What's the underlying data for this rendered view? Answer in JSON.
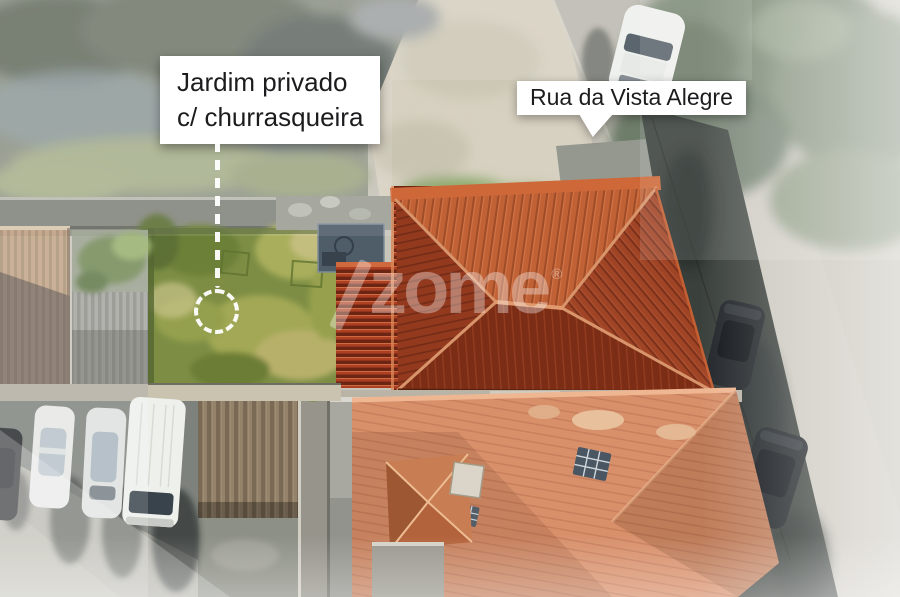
{
  "annotations": {
    "garden_label": {
      "line1": "Jardim privado",
      "line2": "c/ churrasqueira"
    },
    "street_label": {
      "text": "Rua da Vista Alegre"
    },
    "watermark": {
      "text": "zome",
      "registered": "®"
    }
  },
  "colors": {
    "label-bg": "#ffffff",
    "label-text": "#1c1c1e",
    "watermark": "#ffffff",
    "garden-green": "#7d8e44",
    "roof-top": "#c06236",
    "roof-side": "#a04426",
    "roof-dark": "#7b2d16",
    "slat-red": "#ad3f22",
    "salmon-roof": "#d8906b",
    "street": "#bdbab1",
    "shadow-band": "#3a403c",
    "gravel": "#d7d1c1",
    "asphalt": "#7e827c",
    "car-white": "#eef0ec",
    "car-dark": "#23272b"
  }
}
